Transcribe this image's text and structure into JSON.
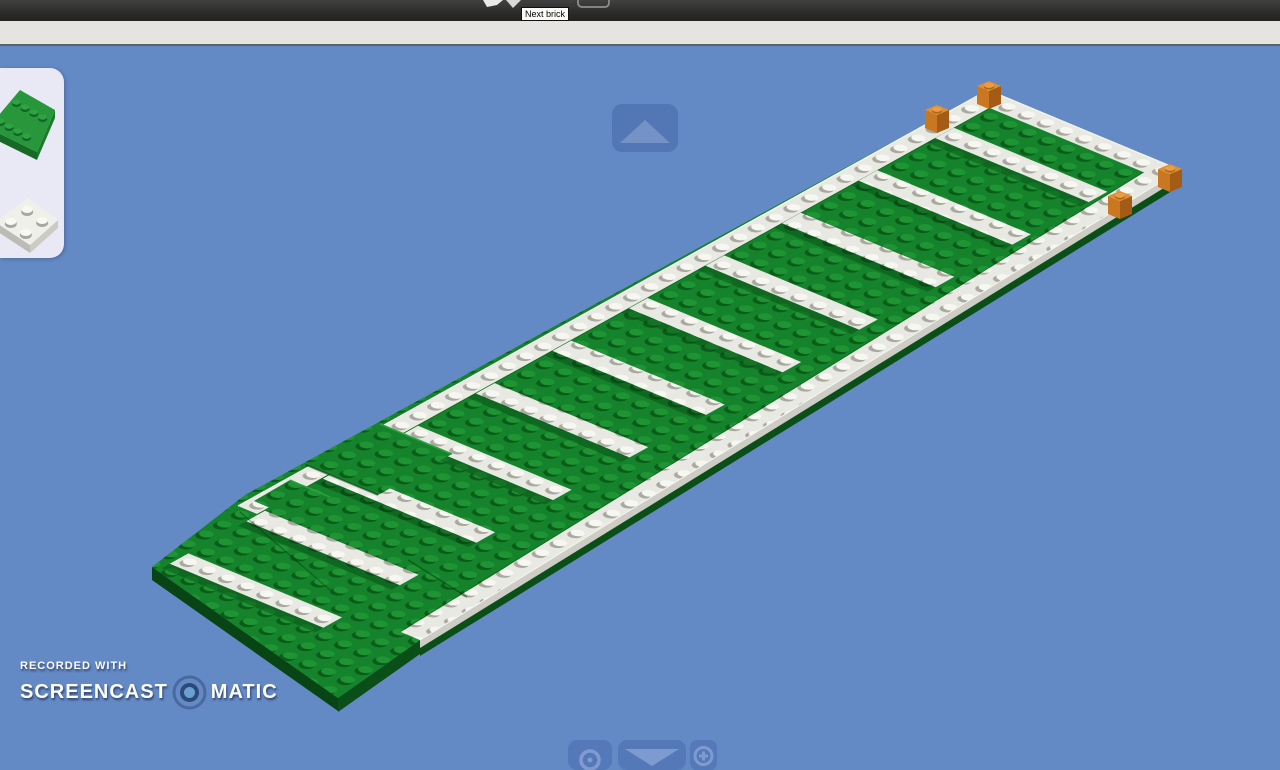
{
  "toolbar": {
    "tooltip_text": "Next brick",
    "icons": [
      "back-arrow-icon",
      "forward-arrow-icon",
      "brick-counter-outline"
    ]
  },
  "viewport": {
    "background_color": "#648ac6",
    "rotate_up_button": "rotate-view-up",
    "bottom_buttons": [
      "screenshot",
      "rotate-view-down",
      "zoom-in"
    ]
  },
  "brick_palette": {
    "items": [
      {
        "id": "green-plate",
        "top": "#28963a",
        "side_right": "#1b7a2b",
        "side_front": "#166a24",
        "stud": "#2fa242",
        "stud_shadow": "#136327"
      },
      {
        "id": "white-plate",
        "top": "#f0f0ea",
        "side_right": "#cbcbc3",
        "side_front": "#bcbcb4",
        "stud": "#f8f8f4",
        "stud_shadow": "#a8a8a0"
      }
    ]
  },
  "scene": {
    "description": "green and white striped LEGO field under construction",
    "stripe_count": 11,
    "corner_marker_count": 4,
    "colors": {
      "field_green": "#15832b",
      "field_green_stud": "#1e9434",
      "field_green_shadow": "#0a5c18",
      "field_green_highlight": "#2fa342",
      "side_dark_green": "#0b4f18",
      "side_darker_green": "#094514",
      "plate_white": "#e9e9e3",
      "plate_white_stud": "#f7f7f2",
      "plate_white_shadow": "#a9a9a0",
      "plate_white_side": "#cdcdc5",
      "plate_white_bright": "#f6f6f1",
      "marker_orange_top": "#df8f33",
      "marker_orange_stud": "#ea9d42",
      "marker_orange_stud_shadow": "#b06818",
      "marker_orange_left": "#c97721",
      "marker_orange_right": "#a35b15"
    }
  },
  "watermark": {
    "recorded_with": "RECORDED WITH",
    "brand_left": "SCREENCAST",
    "brand_right": "MATIC"
  }
}
